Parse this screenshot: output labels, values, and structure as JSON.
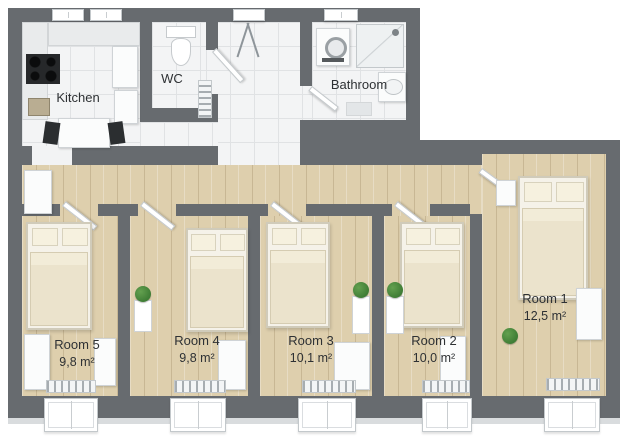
{
  "title": "Apartment floor plan",
  "colors": {
    "wall": "#676b6f",
    "tile": "#f3f4f5",
    "grout": "#e0e2e4",
    "wood": "#decfad",
    "furniture": "#fbfcfc",
    "furniture-border": "#cfd3d6",
    "bed-frame": "#f5f2e9",
    "bed-duvet": "#ebe3cc",
    "bed-pillow": "#f6f1df",
    "plant": "#3f7d35",
    "chair": "#2b2e30",
    "stove": "#26282a",
    "text": "#2e3134"
  },
  "rooms": {
    "kitchen": {
      "label": "Kitchen"
    },
    "wc": {
      "label": "WC"
    },
    "bathroom": {
      "label": "Bathroom"
    },
    "room1": {
      "name": "Room 1",
      "area": "12,5 m²"
    },
    "room2": {
      "name": "Room 2",
      "area": "10,0 m²"
    },
    "room3": {
      "name": "Room 3",
      "area": "10,1 m²"
    },
    "room4": {
      "name": "Room 4",
      "area": "9,8 m²"
    },
    "room5": {
      "name": "Room 5",
      "area": "9,8 m²"
    }
  }
}
